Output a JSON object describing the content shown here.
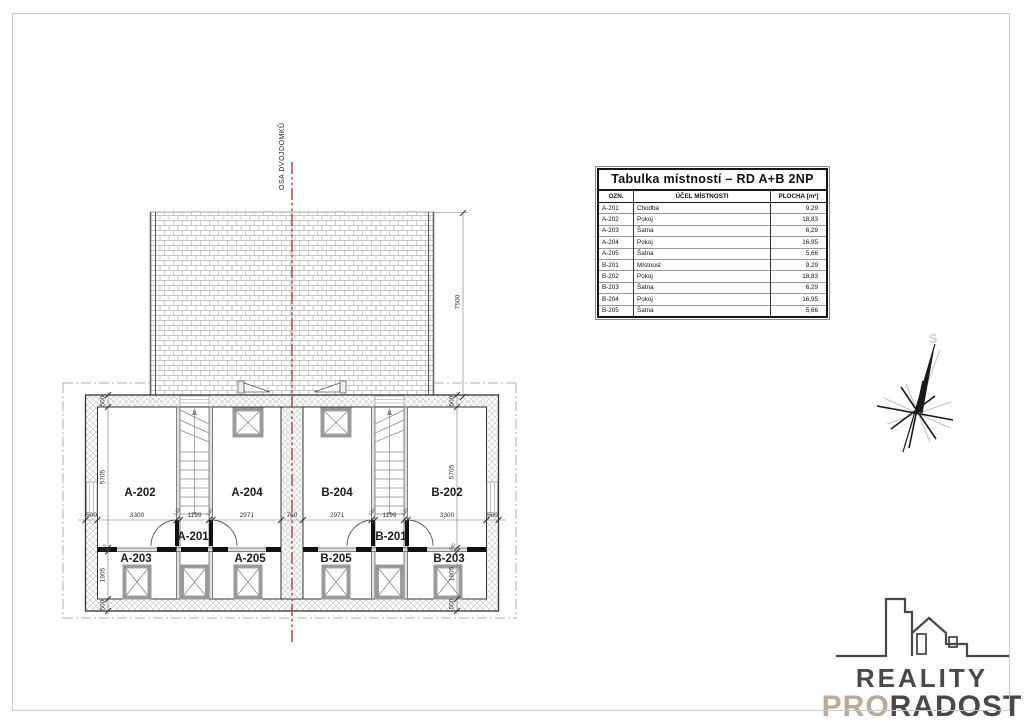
{
  "drawing": {
    "axis_label": "OSA DVOJDOMKŮ",
    "room_labels": {
      "a202": "A-202",
      "a204": "A-204",
      "b204": "B-204",
      "b202": "B-202",
      "a201": "A-201",
      "b201": "B-201",
      "a203": "A-203",
      "a205": "A-205",
      "b205": "B-205",
      "b203": "B-203"
    },
    "dimensions": {
      "wall": "500",
      "room_depth": "5705",
      "partition": "140",
      "closet_depth": "1905",
      "room_a_w": "3300",
      "corridor_w": "1199",
      "room_b_w": "2971",
      "party_wall": "760",
      "roof_depth": "7500"
    }
  },
  "table": {
    "title": "Tabulka místností – RD A+B 2NP",
    "headers": {
      "ozn": "OZN.",
      "ucel": "ÚČEL MÍSTNOSTI",
      "plocha": "PLOCHA [m²]"
    },
    "rows": [
      {
        "ozn": "A-201",
        "ucel": "Chodba",
        "plocha": "9,29"
      },
      {
        "ozn": "A-202",
        "ucel": "Pokoj",
        "plocha": "18,83"
      },
      {
        "ozn": "A-203",
        "ucel": "Šatna",
        "plocha": "6,29"
      },
      {
        "ozn": "A-204",
        "ucel": "Pokoj",
        "plocha": "16,95"
      },
      {
        "ozn": "A-205",
        "ucel": "Šatna",
        "plocha": "5,66"
      },
      {
        "ozn": "B-201",
        "ucel": "Místnost",
        "plocha": "9,29"
      },
      {
        "ozn": "B-202",
        "ucel": "Pokoj",
        "plocha": "18,83"
      },
      {
        "ozn": "B-203",
        "ucel": "Šatna",
        "plocha": "6,29"
      },
      {
        "ozn": "B-204",
        "ucel": "Pokoj",
        "plocha": "16,95"
      },
      {
        "ozn": "B-205",
        "ucel": "Šatna",
        "plocha": "5,66"
      }
    ]
  },
  "compass": {
    "north_label": "S"
  },
  "logo": {
    "line1": "REALITY",
    "line2_pro": "PRO",
    "line2_radost": "RADOST"
  },
  "colors": {
    "axis_red": "#b04848",
    "logo_dark": "#4a4946",
    "logo_beige": "#b9aa99"
  }
}
